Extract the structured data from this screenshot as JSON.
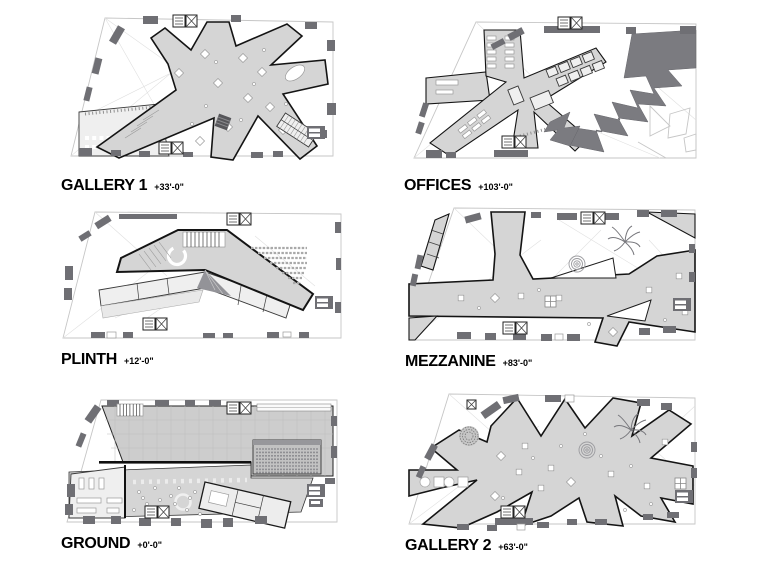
{
  "sheet": {
    "description": "Six stacked building floor plans with level names and elevations",
    "columns": 2,
    "rows": 3
  },
  "floors": [
    {
      "id": "gallery-1",
      "name": "GALLERY 1",
      "elevation": "+33'-0\""
    },
    {
      "id": "offices",
      "name": "OFFICES",
      "elevation": "+103'-0\""
    },
    {
      "id": "plinth",
      "name": "PLINTH",
      "elevation": "+12'-0\""
    },
    {
      "id": "mezzanine",
      "name": "MEZZANINE",
      "elevation": "+83'-0\""
    },
    {
      "id": "ground",
      "name": "GROUND",
      "elevation": "+0'-0\""
    },
    {
      "id": "gallery-2",
      "name": "GALLERY 2",
      "elevation": "+63'-0\""
    }
  ],
  "colors": {
    "background": "#ffffff",
    "floor_plate_fill": "#d5d5d5",
    "core_block_gray": "#6f6f74",
    "offices_dark_mass": "#7b7b80",
    "plan_outline": "#141414",
    "site_line": "#c6c6c6",
    "label_text": "#000000"
  }
}
